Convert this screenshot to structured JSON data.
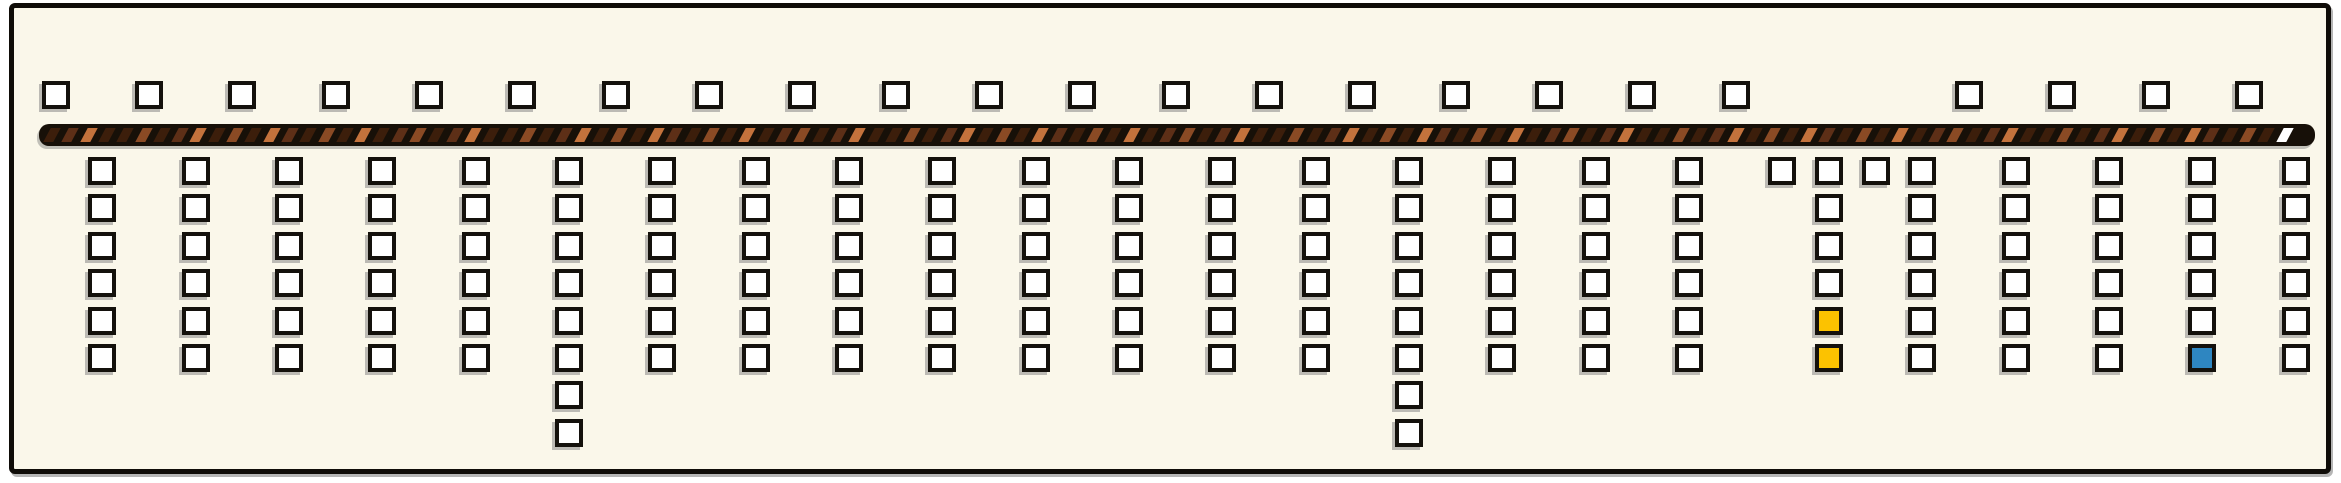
{
  "board": {
    "background": "#faf7ea",
    "border_color": "#0f0c08"
  },
  "colors": {
    "square_fill": "#ffffff",
    "square_border": "#14110c",
    "highlight_yellow": "#fcc200",
    "highlight_blue": "#2e86c1",
    "bar_background": "#171008",
    "end_segment_white": "#ffffff"
  },
  "top_row": {
    "y": 76,
    "square_size": 28,
    "xs": [
      37,
      130,
      223,
      317,
      410,
      503,
      597,
      690,
      783,
      877,
      970,
      1063,
      1157,
      1250,
      1343,
      1437,
      1530,
      1623,
      1717,
      1950,
      2043,
      2137,
      2230
    ]
  },
  "bar": {
    "x": 34,
    "y": 119,
    "width": 2276,
    "height": 22,
    "stripe_pitch": 18.3,
    "stripe_width": 10,
    "stripe_inset": 8,
    "palette": [
      "#3c1e0b",
      "#5d2f17",
      "#8a4a24",
      "#c3723c",
      "#d18c58"
    ],
    "pattern": [
      0,
      1,
      3,
      0,
      0,
      2,
      0,
      1,
      3,
      0,
      2,
      0,
      3,
      1,
      0,
      2,
      0,
      3,
      0,
      1,
      2
    ],
    "last_stripe_color": "#ffffff"
  },
  "grid": {
    "row0_y": 152,
    "row_pitch": 37.4,
    "square_size": 28
  },
  "columns": [
    {
      "x": 83,
      "count": 6,
      "highlights": {}
    },
    {
      "x": 177,
      "count": 6,
      "highlights": {}
    },
    {
      "x": 270,
      "count": 6,
      "highlights": {}
    },
    {
      "x": 363,
      "count": 6,
      "highlights": {}
    },
    {
      "x": 457,
      "count": 6,
      "highlights": {}
    },
    {
      "x": 550,
      "count": 8,
      "highlights": {}
    },
    {
      "x": 643,
      "count": 6,
      "highlights": {}
    },
    {
      "x": 737,
      "count": 6,
      "highlights": {}
    },
    {
      "x": 830,
      "count": 6,
      "highlights": {}
    },
    {
      "x": 923,
      "count": 6,
      "highlights": {}
    },
    {
      "x": 1017,
      "count": 6,
      "highlights": {}
    },
    {
      "x": 1110,
      "count": 6,
      "highlights": {}
    },
    {
      "x": 1203,
      "count": 6,
      "highlights": {}
    },
    {
      "x": 1297,
      "count": 6,
      "highlights": {}
    },
    {
      "x": 1390,
      "count": 8,
      "highlights": {}
    },
    {
      "x": 1483,
      "count": 6,
      "highlights": {}
    },
    {
      "x": 1577,
      "count": 6,
      "highlights": {}
    },
    {
      "x": 1670,
      "count": 6,
      "highlights": {}
    },
    {
      "x": 1763,
      "count": 1,
      "highlights": {}
    },
    {
      "x": 1810,
      "count": 6,
      "highlights": {
        "4": "yellow",
        "5": "yellow"
      }
    },
    {
      "x": 1857,
      "count": 1,
      "highlights": {}
    },
    {
      "x": 1903,
      "count": 6,
      "highlights": {}
    },
    {
      "x": 1997,
      "count": 6,
      "highlights": {}
    },
    {
      "x": 2090,
      "count": 6,
      "highlights": {}
    },
    {
      "x": 2183,
      "count": 6,
      "highlights": {
        "5": "blue"
      }
    },
    {
      "x": 2277,
      "count": 6,
      "highlights": {}
    }
  ]
}
